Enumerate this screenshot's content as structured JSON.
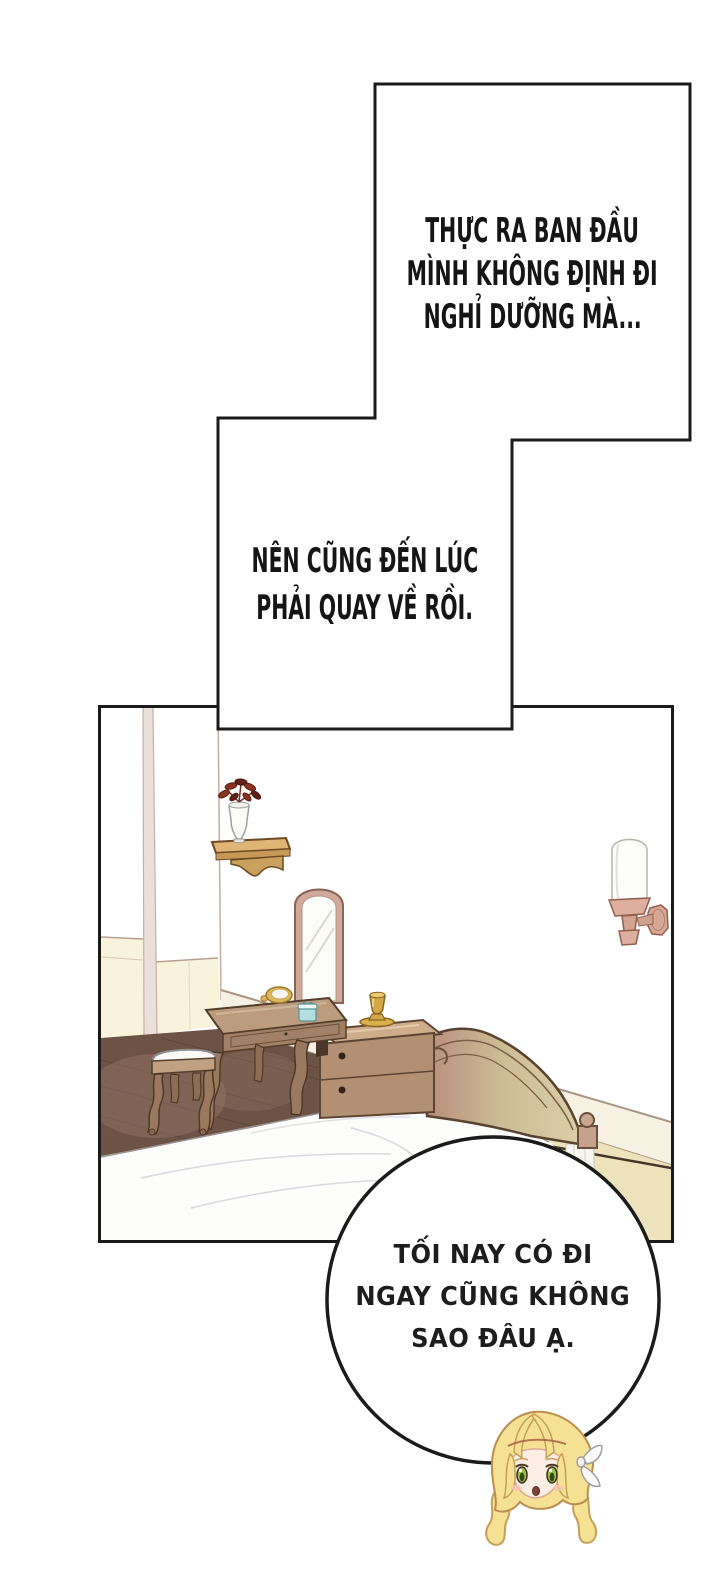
{
  "page": {
    "type": "webtoon-comic-page",
    "background": "#ffffff",
    "ink": "#1b1b1b"
  },
  "narration_box_1": {
    "lines": [
      "THỰC RA BAN ĐẦU",
      "MÌNH KHÔNG ĐỊNH ĐI",
      "NGHỈ DƯỠNG MÀ..."
    ]
  },
  "narration_box_2": {
    "lines": [
      "NÊN CŨNG ĐẾN LÚC",
      "PHẢI QUAY VỀ RỒI."
    ]
  },
  "speech_bubble": {
    "lines": [
      "TỐI NAY CÓ ĐI",
      "NGAY CŨNG KHÔNG",
      "SAO ĐÂU Ạ."
    ]
  },
  "colors": {
    "ink": "#1b1b1b",
    "floor_wood": "#6d5346",
    "floor_cream": "#ece3bd",
    "wainscot_cream": "#f9f3dc",
    "pilaster": "#ebdfda",
    "baseboard_strip": "#f6f1e3",
    "furniture_wood": "#b29073",
    "furniture_wood_top": "#cdad8c",
    "table_wood": "#bb9c7e",
    "headboard_left": "#b78f7c",
    "headboard_mid": "#cdbd96",
    "headboard_right": "#d9cda8",
    "shelf_wood": "#dfb475",
    "plant_leaf": "#8c3220",
    "sconce_base": "#dcaf9e",
    "goblet_gold": "#d3a848",
    "jar_cyan": "#b3dfe2",
    "cushion_white": "#fbfaf6",
    "sheet_white": "#fdfdfc",
    "hair_gold": "#f5e193",
    "skin": "#fdeee5",
    "eye_green": "#9dc24c",
    "blush_pink": "#f8c5b1"
  }
}
